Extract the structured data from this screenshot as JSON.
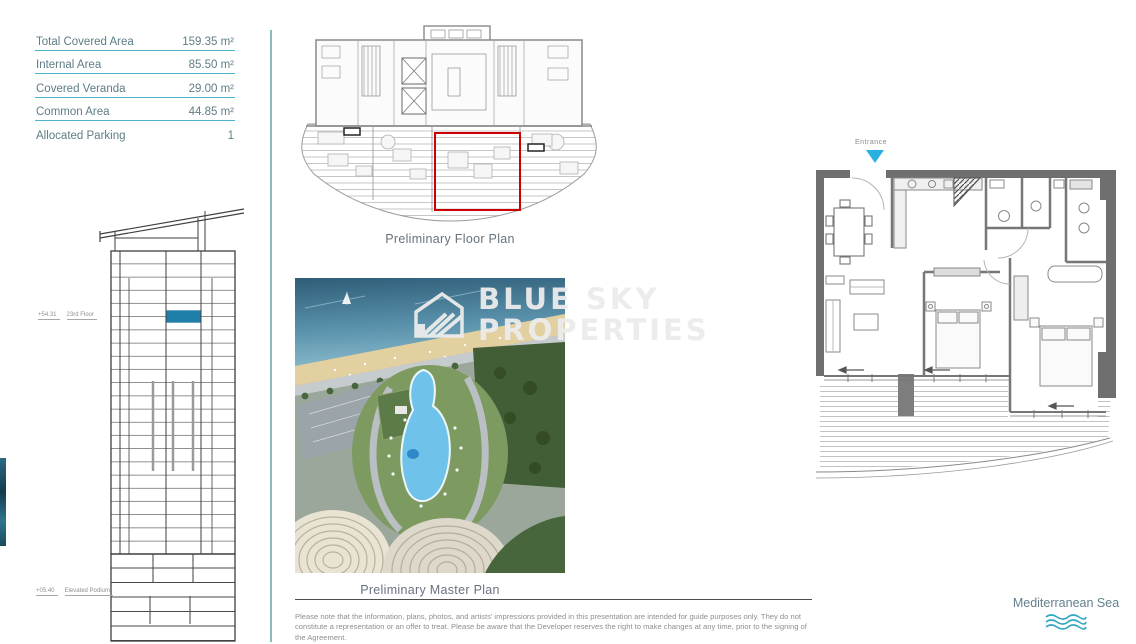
{
  "area_table": {
    "rows": [
      {
        "label": "Total Covered Area",
        "value": "159.35 m²"
      },
      {
        "label": "Internal Area",
        "value": "85.50 m²"
      },
      {
        "label": "Covered Veranda",
        "value": "29.00 m²"
      },
      {
        "label": "Common Area",
        "value": "44.85 m²"
      },
      {
        "label": "Allocated Parking",
        "value": "1"
      }
    ]
  },
  "elevation": {
    "floor_level": "+54.31",
    "floor_label": "23rd Floor",
    "podium_level": "+05.40",
    "podium_label": "Elevated Podium"
  },
  "floor_plan": {
    "caption": "Preliminary Floor Plan"
  },
  "master_plan": {
    "caption": "Preliminary Master Plan",
    "watermark_line1": "BLUE SKY",
    "watermark_line2": "PROPERTIES"
  },
  "apartment_plan": {
    "entrance_label": "Entrance"
  },
  "sea_label": {
    "text": "Mediterranean Sea"
  },
  "disclaimer": "Please note that the information, plans, photos, and artists' impressions provided in this presentation are intended for guide purposes only. They do not constitute a representation or an offer to treat. Please be aware that the Developer reserves the right to make changes at any time, prior to the signing of the Agreement.",
  "colors": {
    "accent_line": "#4fb3cf",
    "table_text": "#5e7d86",
    "floor_highlight": "#1f7fa8",
    "unit_outline_red": "#cc0000",
    "entrance_arrow": "#29b0e0",
    "wave": "#2fa6c4",
    "divider": "#8ab9c2"
  }
}
